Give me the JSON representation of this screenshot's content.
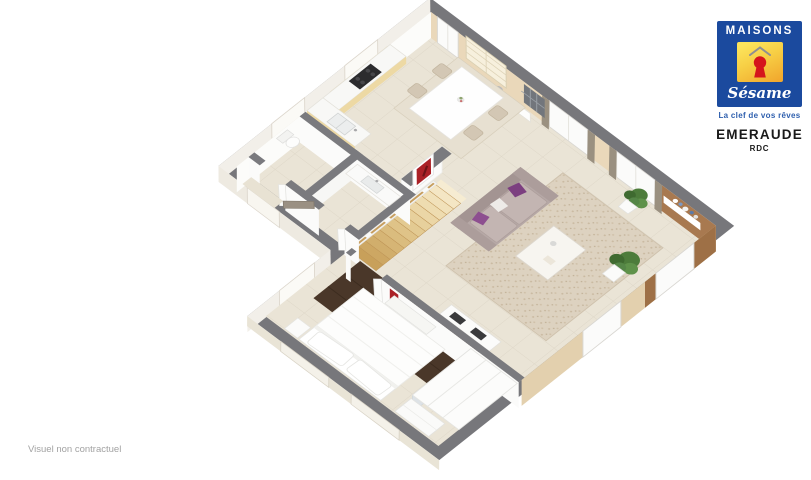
{
  "branding": {
    "name_top": "MAISONS",
    "name_bottom": "Sésame",
    "tagline": "La clef de vos rêves",
    "colors": {
      "logo_blue": "#1b4a9e",
      "logo_yellow": "#f7cf45",
      "keyhole_red": "#d5141c",
      "tagline_blue": "#2e5fae"
    }
  },
  "plan": {
    "title": "EMERAUDE",
    "level": "RDC"
  },
  "footer": {
    "disclaimer": "Visuel non contractuel"
  },
  "floorplan": {
    "type": "3d-isometric-floor-plan",
    "level_shown": "ground floor (RDC)",
    "rooms": [
      "kitchen",
      "dining area",
      "living room",
      "entrance hall",
      "wc",
      "bathroom",
      "staircase",
      "bedroom"
    ],
    "furniture": [
      "kitchen counter with cooktop and sink",
      "wall cabinets",
      "display cabinet",
      "dining table with four chairs",
      "console with mirror",
      "sofa with purple cushions",
      "coffee table",
      "area rug",
      "tv lowboard",
      "floating shelf with vases",
      "two green plants",
      "wooden staircase with railing",
      "double bed with pillows",
      "dark brown rug",
      "wardrobe with mirror doors",
      "dresser",
      "nightstand",
      "toilet",
      "vanity basin"
    ],
    "colors": {
      "wall_top_gray": "#77777b",
      "floor_tile": "#eae4d6",
      "beige_wall": "#ead8ba",
      "accent_brown_wall": "#a87950",
      "stairs_wood": "#ddbb80",
      "sofa_gray": "#b6a8a6",
      "pillow_purple": "#7c3f80",
      "bedroom_rug_brown": "#4a3729",
      "curtain_taupe": "#9a9080"
    }
  }
}
